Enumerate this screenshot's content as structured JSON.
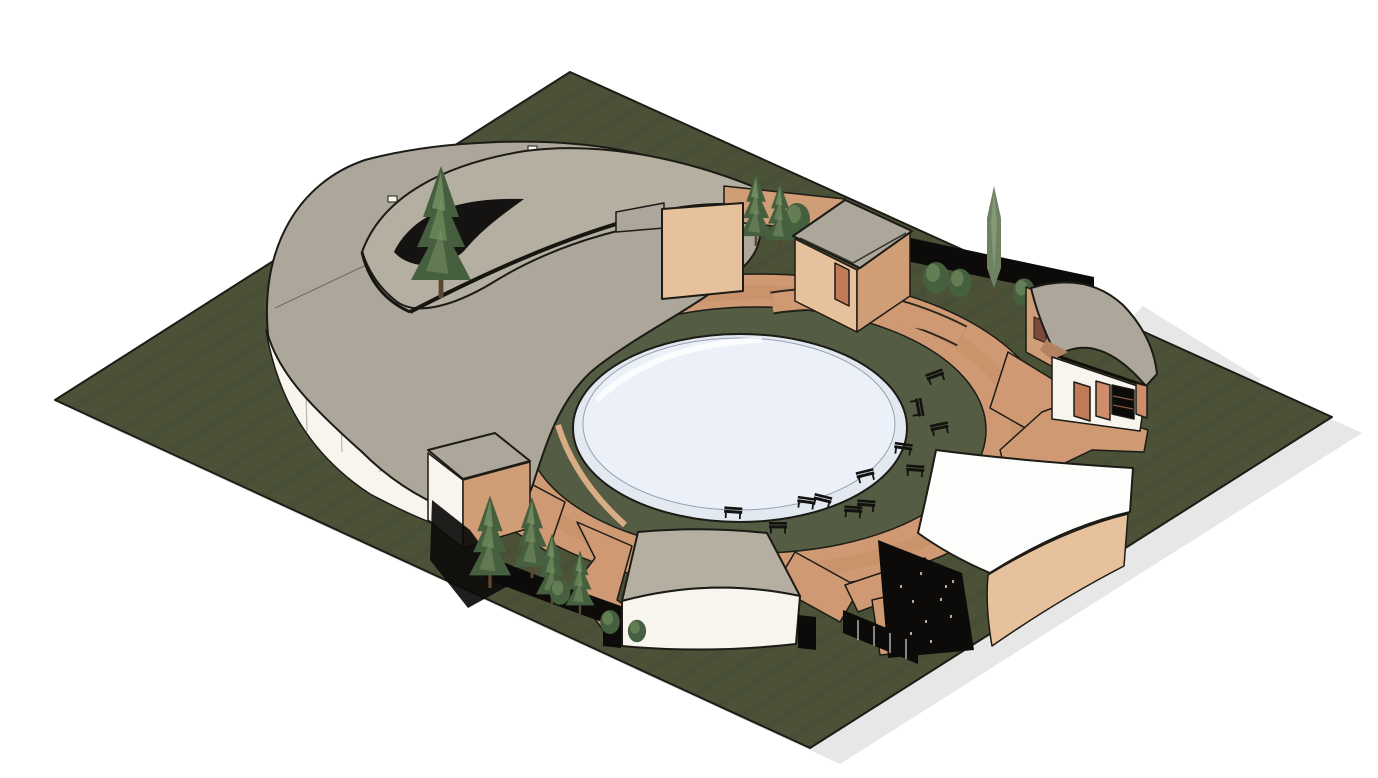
{
  "meta": {
    "title": "Isometric 3D architectural site rendering",
    "description": "Axonometric model view of a circular courtyard complex with central round pool on a square landscaped lot, white background",
    "view": "isometric-3d",
    "visible_text": []
  },
  "colors": {
    "background": "#ffffff",
    "shadow": "#e7e7e7",
    "outline": "#1c1b16",
    "grass": "#4b5238",
    "grass_inner": "#545c43",
    "walkway": "#cf9a73",
    "walkway_shade": "#c18a60",
    "pool_rim": "#e3e9f1",
    "pool_water": "#ecf1f9",
    "pool_edge": "#97a1b0",
    "roof_gray": "#aca79a",
    "roof_light": "#b5afa2",
    "roof_white": "#fdfdfb",
    "wall_white": "#f7f5ee",
    "brick_light": "#e6c19b",
    "brick_mid": "#cf9d76",
    "brick_dark": "#b3835f",
    "interior": "#2e2d28",
    "black": "#0c0b0a",
    "door": "#c07a58",
    "shutter": "#cf8d6b",
    "window_frame": "#7a4a3a",
    "tree_dark": "#465f3e",
    "tree_light": "#7b9668",
    "cypress": "#6e8263",
    "cypress_light": "#8aa07c",
    "trunk": "#5b4632",
    "bench": "#141210",
    "seam": "#6e6a60",
    "joint": "#b9b5aa",
    "inner_path": "#d8ad85"
  },
  "scene": {
    "site": {
      "shape": "square lot shown as diamond in isometric view",
      "ground": "dark green lawn with mowing texture",
      "drop_shadow": "light gray, offset lower-right"
    },
    "courtyard": {
      "walkway": "terracotta circular ring path with radiating spurs",
      "inner_ring": "circular lawn strip",
      "pool": "central circular pool, pale blue water with white rim"
    },
    "buildings": [
      {
        "name": "spiral-roof-pavilion",
        "position": "north-west",
        "features": "large two-tier gray crescent roof, crescent skylight courtyard with conifer, white curved outer wall, shaded brick inner walls"
      },
      {
        "name": "freestanding-brick-walls",
        "position": "north",
        "features": "tan brick garden walls with trees behind"
      },
      {
        "name": "cube-kiosk",
        "position": "north-east",
        "features": "brick cube, flat gray roof, terracotta door"
      },
      {
        "name": "gatehouse",
        "position": "east",
        "features": "curved gray roof, brick side wall with window, white front with door, shutters and dark display window"
      },
      {
        "name": "curved-hall",
        "position": "south-east",
        "features": "white curved roof, curved brick front, dark perforated end facade"
      },
      {
        "name": "arc-pavilion",
        "position": "south",
        "features": "gray fan-shaped roof over white curved wall"
      },
      {
        "name": "service-kiosk",
        "position": "west",
        "features": "flat gray roof, white and brick walls"
      }
    ],
    "landscape": {
      "conifer_count": 7,
      "cypress_count": 1,
      "bush_count": 8,
      "fence_rows": 3,
      "fences": "black slatted screen fences along north-east edge, south-west curve and south path"
    },
    "furniture": {
      "bench_count": 14,
      "bench_layout": "park benches arched around the east and south of the pool lawn"
    }
  }
}
